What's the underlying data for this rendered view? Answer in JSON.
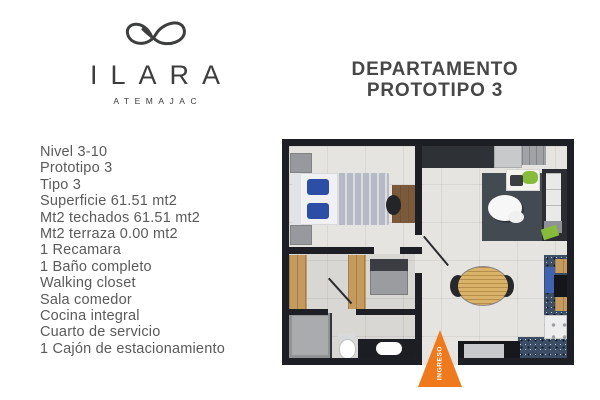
{
  "brand": {
    "name": "ILARA",
    "subtitle": "ATEMAJAC",
    "logo_icon": "infinity-ribbon-icon"
  },
  "title": {
    "line1": "DEPARTAMENTO",
    "line2": "PROTOTIPO 3"
  },
  "specs": [
    "Nivel 3-10",
    "Prototipo 3",
    "Tipo 3",
    "Superficie 61.51 mt2",
    "Mt2 techados 61.51 mt2",
    "Mt2 terraza 0.00 mt2",
    "1 Recamara",
    "1 Baño completo",
    "Walking closet",
    "Sala comedor",
    "Cocina integral",
    "Cuarto de servicio",
    "1 Cajón de estacionamiento"
  ],
  "floorplan": {
    "entrance_label": "INGRESO",
    "colors": {
      "wall": "#1e1f24",
      "floor": "#e6e4e0",
      "rug": "#444a52",
      "wood": "#c59a5f",
      "wood_dark": "#7b5a3b",
      "granite": "#3c4e66",
      "sink_blue": "#3f63b0",
      "pillow_blue": "#2c4ea4",
      "sofa_dark": "#2b2d32",
      "cushion_white": "#e9e9e8",
      "accent_green": "#86bb3c",
      "furniture_gray": "#9a9ca0",
      "accent_orange": "#ef7a1e",
      "brand_ink": "#3d3d3d",
      "text_gray": "#5a5a5a"
    }
  }
}
